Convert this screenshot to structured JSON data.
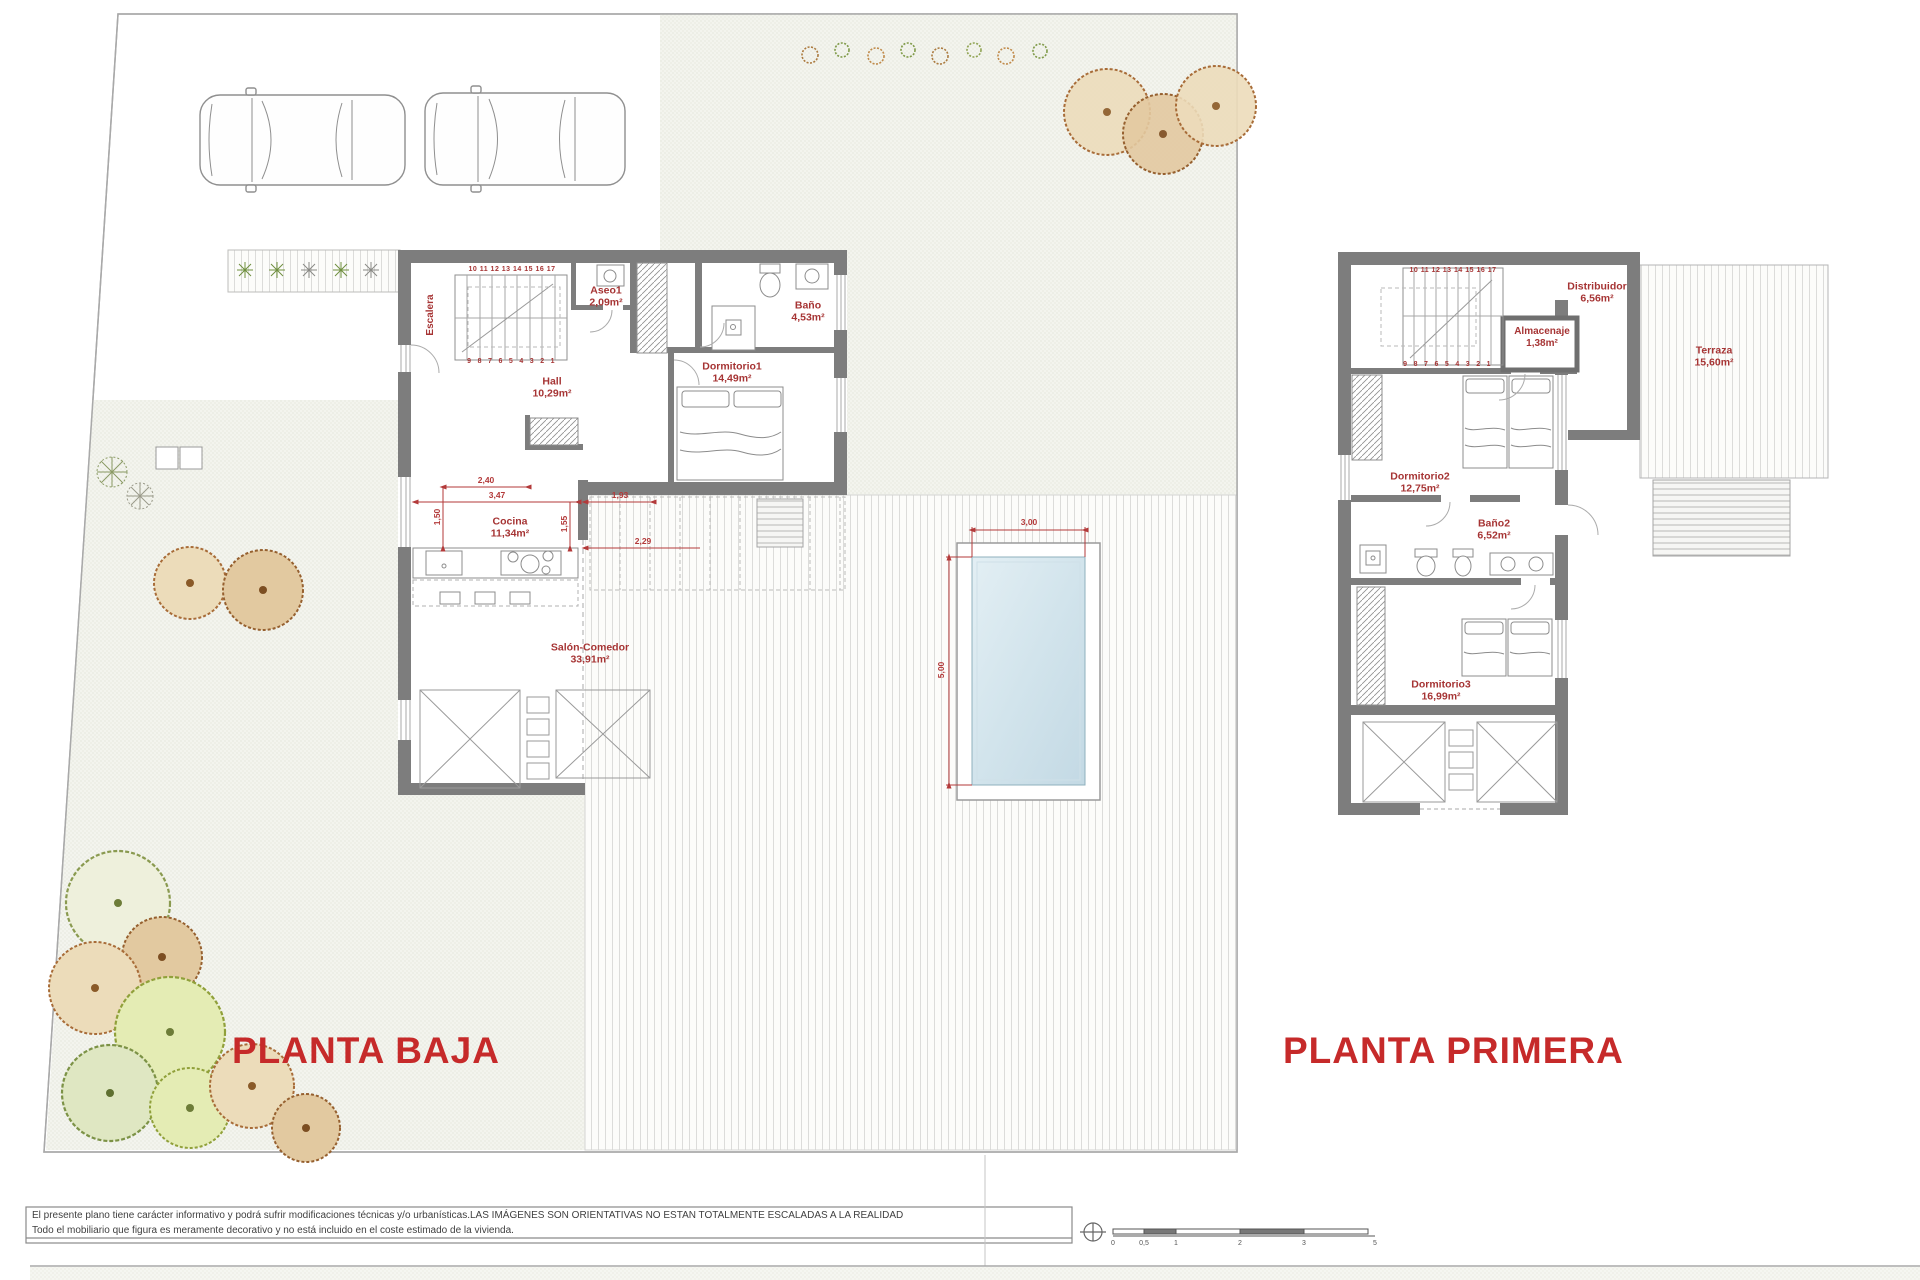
{
  "colors": {
    "label_red": "#a63434",
    "title_red": "#c62a2a",
    "wall_gray": "#7d7d7d",
    "pool_blue": "#cfe3ec"
  },
  "titles": {
    "ground": "PLANTA BAJA",
    "first": "PLANTA PRIMERA"
  },
  "ground_floor": {
    "escalera": {
      "name": "Escalera"
    },
    "stairs_top": "10 11 12 13 14 15 16 17",
    "stairs_bottom": "9 8 7 6 5 4 3 2 1",
    "aseo1": {
      "name": "Aseo1",
      "area": "2,09m²"
    },
    "bano": {
      "name": "Baño",
      "area": "4,53m²"
    },
    "dormitorio1": {
      "name": "Dormitorio1",
      "area": "14,49m²"
    },
    "hall": {
      "name": "Hall",
      "area": "10,29m²"
    },
    "cocina": {
      "name": "Cocina",
      "area": "11,34m²"
    },
    "salon": {
      "name": "Salón-Comedor",
      "area": "33,91m²"
    },
    "dims": {
      "d240": "2,40",
      "d347": "3,47",
      "d193": "1,93",
      "d150": "1,50",
      "d155": "1,55",
      "d229": "2,29"
    },
    "pool_dims": {
      "w": "3,00",
      "h": "5,00"
    }
  },
  "first_floor": {
    "stairs_top": "10 11 12 13 14 15 16 17",
    "stairs_bottom": "9 8 7 6 5 4 3 2 1",
    "distribuidor": {
      "name": "Distribuidor",
      "area": "6,56m²"
    },
    "almacenaje": {
      "name": "Almacenaje",
      "area": "1,38m²"
    },
    "terraza": {
      "name": "Terraza",
      "area": "15,60m²"
    },
    "dormitorio2": {
      "name": "Dormitorio2",
      "area": "12,75m²"
    },
    "bano2": {
      "name": "Baño2",
      "area": "6,52m²"
    },
    "dormitorio3": {
      "name": "Dormitorio3",
      "area": "16,99m²"
    }
  },
  "footer": {
    "line1": "El presente plano tiene carácter informativo y podrá sufrir modificaciones técnicas y/o urbanísticas.LAS IMÁGENES SON ORIENTATIVAS NO ESTAN TOTALMENTE ESCALADAS A LA REALIDAD",
    "line2": "Todo el mobiliario que figura es meramente decorativo y no está incluido en el coste estimado de la vivienda.",
    "scale_labels": [
      "0",
      "0,5",
      "1",
      "2",
      "3",
      "5"
    ]
  }
}
